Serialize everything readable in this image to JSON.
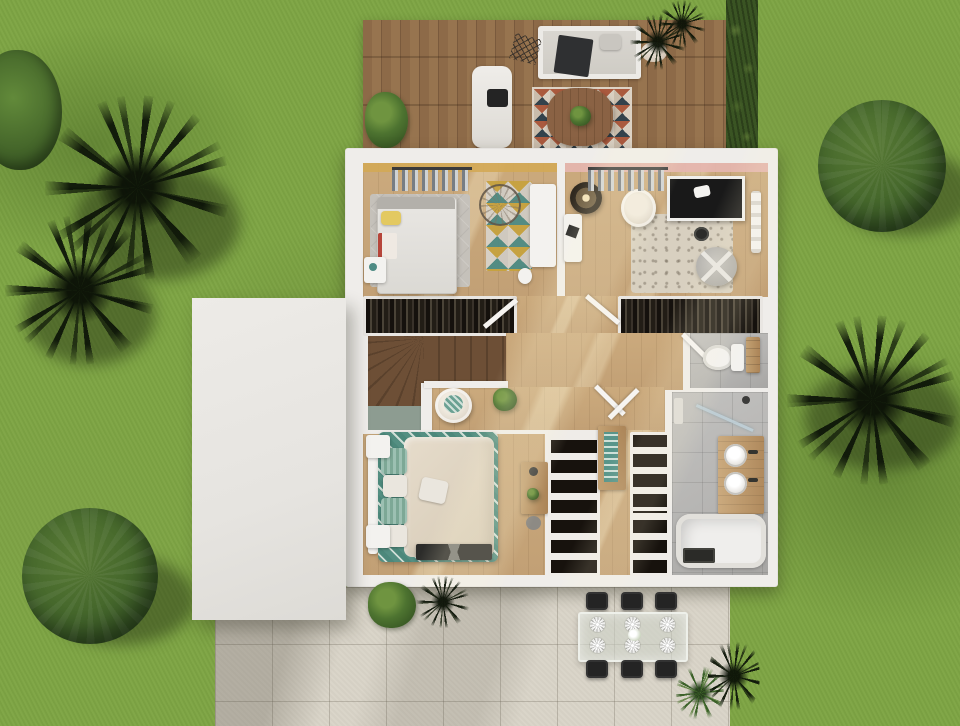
{
  "title": "Aerial 3D render of furnished upper-floor house plan with garden, wooden deck and patio",
  "colors": {
    "grass": "#7ea544",
    "grass_shade": "#637f36",
    "deck_wood": "#8d6a48",
    "deck_wood_dark": "#7a5a3d",
    "hedge": "#3a5423",
    "wall_white": "#efedea",
    "roof_white": "#e6e4e0",
    "floor_wood": "#c2a075",
    "stair_wood": "#6d4f36",
    "stair_wood_dark": "#5a412c",
    "sage": "#8d9c91",
    "patio_concrete": "#d9d4c8",
    "tile_gray": "#b5b4b2",
    "pink_wall": "#e6b6b0",
    "mustard_wall": "#d3a955",
    "dark_clothes": "#221d16",
    "teal": "#4e8b84",
    "teal_light": "#9cc0b2",
    "bed_beige": "#d6cab6",
    "cream": "#eae6de",
    "rug_gray": "#c5c1ba",
    "rug_beige": "#d8d0c0",
    "wood_furniture": "#c3a173",
    "black_furniture": "#242424",
    "white_fixture": "#f3f2ef",
    "tree_green": "#355424",
    "tree_green_light": "#587a35"
  },
  "scene": {
    "description": "Top-down architectural render: house upper floor with two kids bedrooms, built-in wardrobes, staircase, hallway, WC, master bedroom, walk-in closet and bathroom; wooden sun deck above, white flat roof at left, concrete patio with outdoor dining set below, lawn with palms, round trees and shrubs around",
    "deck": {
      "name": "wooden sun deck",
      "items": [
        "outdoor sofa with dark throw",
        "chaise lounge with black cushion",
        "diamond-pattern rug",
        "round plank coffee table with plant",
        "wire decor",
        "green potted plant",
        "two dark potted palms"
      ]
    },
    "rooms": [
      {
        "name": "kids bedroom",
        "wall_accent": "mustard",
        "items": [
          "single bed with yellow pillow",
          "grey rug",
          "open clothes rail",
          "geometric triangle rug",
          "white console",
          "rattan wall ring",
          "nightstand",
          "waste bin"
        ]
      },
      {
        "name": "nursery",
        "wall_accent": "pink",
        "items": [
          "rattan pendant",
          "white desk",
          "cream armchair",
          "beige rug",
          "black-and-white crib",
          "grey strap pouf",
          "open clothes rail",
          "wall shelf",
          "dark side table"
        ]
      },
      {
        "name": "landing and hallway",
        "items": [
          "left wardrobe with hanging clothes",
          "right wardrobe with hanging clothes",
          "double doors",
          "winder staircase",
          "sage landing"
        ]
      },
      {
        "name": "wc",
        "items": [
          "toilet",
          "wooden shelf"
        ]
      },
      {
        "name": "master bedroom",
        "items": [
          "double bed with teal patterned throw",
          "four pillows",
          "two white nightstands",
          "x-leg foot bench",
          "round armchair with teal cushion",
          "potted plant",
          "wooden desk with stool"
        ]
      },
      {
        "name": "walk-in closet",
        "items": [
          "shelf tower with folded clothes",
          "wooden dresser with teal runner",
          "two more shelf towers"
        ]
      },
      {
        "name": "bathroom",
        "items": [
          "glass shower screen",
          "wooden double-sink vanity",
          "bathtub",
          "dark bath mat"
        ]
      }
    ],
    "patio": {
      "name": "concrete patio",
      "items": [
        "glass dining table",
        "six black chairs",
        "six place settings",
        "flower centerpiece",
        "green palm plant",
        "dark plant",
        "green bush",
        "black plant"
      ]
    },
    "garden": {
      "items": [
        "lawn",
        "top-left shrub",
        "two dark palms left",
        "round tree bottom-left",
        "round tree right",
        "dark palm right",
        "hedge beside deck"
      ]
    }
  }
}
